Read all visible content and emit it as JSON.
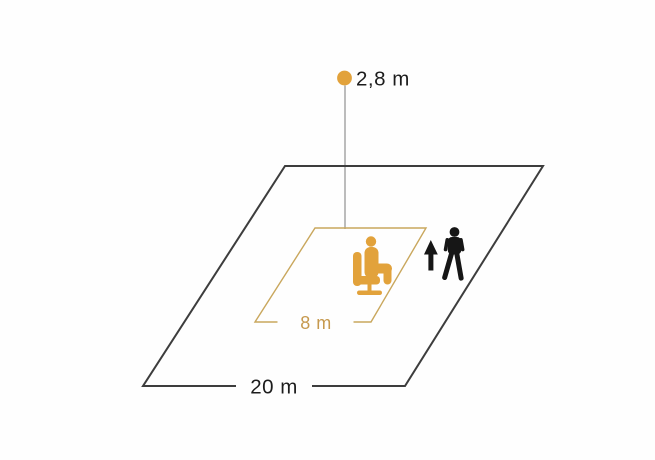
{
  "diagram": {
    "type": "motion-sensor-detection-range",
    "background_color": "#FEFEFE",
    "sensor": {
      "label": "2,8 m",
      "dot_color": "#E2A23B",
      "drop_line_color": "#7A7A7A"
    },
    "outer_zone": {
      "label": "20 m",
      "stroke_color": "#3D3D3D",
      "label_color": "#1C1C1C"
    },
    "inner_zone": {
      "label": "8 m",
      "stroke_color": "#C9A75D",
      "label_color": "#C6994E"
    },
    "figures": {
      "seated_person_color": "#E2A23B",
      "walking_person_color": "#161616",
      "arrow_color": "#161616"
    },
    "icons": [
      {
        "name": "sensor-dot-icon",
        "meaning": "mounted sensor point"
      },
      {
        "name": "seated-person-icon",
        "meaning": "presence detection (seated)"
      },
      {
        "name": "walking-person-icon",
        "meaning": "motion detection (walking)"
      },
      {
        "name": "up-arrow-icon",
        "meaning": "walking direction"
      }
    ]
  }
}
